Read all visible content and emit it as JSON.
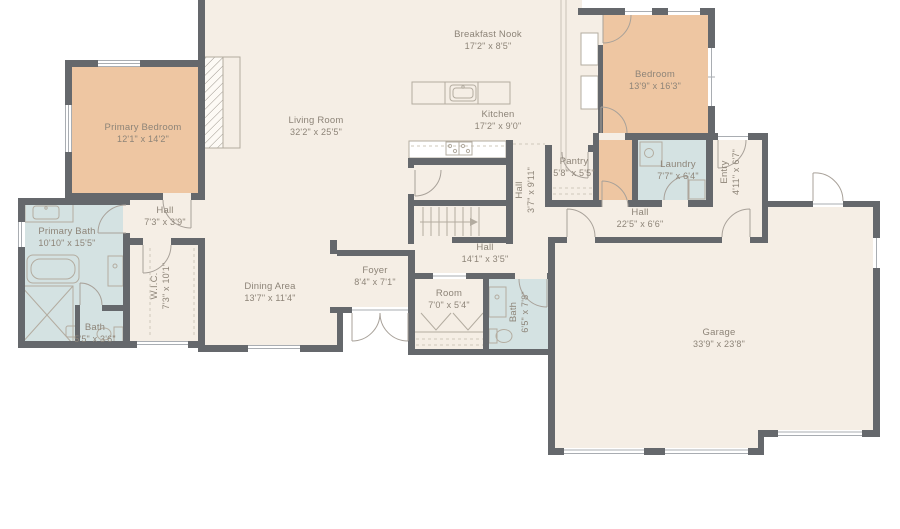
{
  "palette": {
    "floor": "#f5eee5",
    "bedroom_fill": "#eec6a2",
    "bath_fill": "#d4e2e2",
    "wall": "#65686c",
    "label_text": "#8d8478",
    "fixture_line": "#b3aca0",
    "outside": "#ffffff"
  },
  "rooms": [
    {
      "name": "Breakfast Nook",
      "dims": "17'2\" x 8'5\"",
      "x": 488,
      "y": 41,
      "vertical": false
    },
    {
      "name": "Living Room",
      "dims": "32'2\" x 25'5\"",
      "x": 316,
      "y": 127,
      "vertical": false
    },
    {
      "name": "Kitchen",
      "dims": "17'2\" x 9'0\"",
      "x": 498,
      "y": 121,
      "vertical": false
    },
    {
      "name": "Primary Bedroom",
      "dims": "12'1\" x 14'2\"",
      "x": 143,
      "y": 134,
      "vertical": false
    },
    {
      "name": "Bedroom",
      "dims": "13'9\" x 16'3\"",
      "x": 655,
      "y": 81,
      "vertical": false
    },
    {
      "name": "Pantry",
      "dims": "5'8\" x 5'5\"",
      "x": 574,
      "y": 168,
      "vertical": false
    },
    {
      "name": "Laundry",
      "dims": "7'7\" x 6'4\"",
      "x": 678,
      "y": 171,
      "vertical": false
    },
    {
      "name": "Entry",
      "dims": "4'11\" x 6'7\"",
      "x": 731,
      "y": 172,
      "vertical": true
    },
    {
      "name": "Hall",
      "dims": "3'7\" x 9'11\"",
      "x": 526,
      "y": 190,
      "vertical": true
    },
    {
      "name": "Hall",
      "dims": "7'3\" x 3'9\"",
      "x": 165,
      "y": 217,
      "vertical": false
    },
    {
      "name": "Hall",
      "dims": "14'1\" x 3'5\"",
      "x": 485,
      "y": 254,
      "vertical": false
    },
    {
      "name": "Hall",
      "dims": "22'5\" x 6'6\"",
      "x": 640,
      "y": 219,
      "vertical": false
    },
    {
      "name": "Primary Bath",
      "dims": "10'10\" x 15'5\"",
      "x": 67,
      "y": 238,
      "vertical": false
    },
    {
      "name": "W.I.C.",
      "dims": "7'3\" x 10'1\"",
      "x": 161,
      "y": 286,
      "vertical": true
    },
    {
      "name": "Bath",
      "dims": "5'5\" x 3'6\"",
      "x": 95,
      "y": 334,
      "vertical": false
    },
    {
      "name": "Dining Area",
      "dims": "13'7\" x 11'4\"",
      "x": 270,
      "y": 293,
      "vertical": false
    },
    {
      "name": "Foyer",
      "dims": "8'4\" x 7'1\"",
      "x": 375,
      "y": 277,
      "vertical": false
    },
    {
      "name": "Room",
      "dims": "7'0\" x 5'4\"",
      "x": 449,
      "y": 300,
      "vertical": false
    },
    {
      "name": "Bath",
      "dims": "6'5\" x 7'8\"",
      "x": 520,
      "y": 312,
      "vertical": true
    },
    {
      "name": "Garage",
      "dims": "33'9\" x 23'8\"",
      "x": 719,
      "y": 339,
      "vertical": false
    }
  ]
}
